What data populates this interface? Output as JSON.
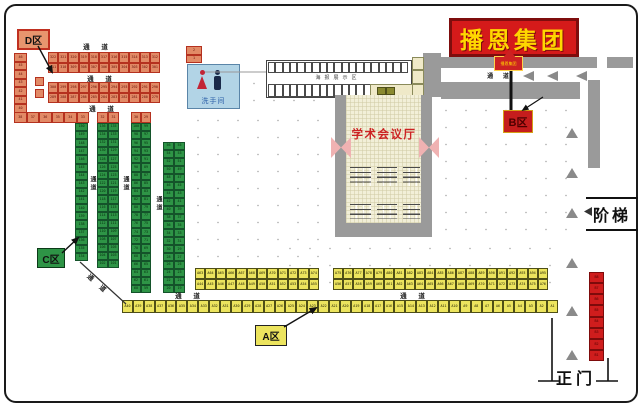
{
  "sign": {
    "text": "播恩集团"
  },
  "zones": {
    "d": "D区",
    "c": "C区",
    "a": "A区",
    "b": "B区"
  },
  "labels": {
    "aisle": "通 道",
    "aisle_v": "通道",
    "restroom": "洗手间",
    "hall": "学术会议厅",
    "stairs": "阶梯",
    "gate": "正门",
    "display_area": "海报展示区",
    "wall_booth": "播恩集团"
  },
  "colors": {
    "sign_bg": "#d51a1a",
    "sign_text": "#ffd700",
    "sign_border": "#7e0d0d",
    "seat_red": "#e28a66",
    "seat_red_border": "#b5311f",
    "seat_green": "#2e9446",
    "seat_green_border": "#14532a",
    "seat_yellow": "#ece45e",
    "seat_yellow_border": "#4f4f17",
    "seat_deepred": "#cf1d1d",
    "wall_gray": "#9a9a9a",
    "door_pink": "#f0b2b2",
    "hall_floor": "#f2efd8",
    "hall_text": "#cc2222",
    "restroom_bg": "#b2d4e6",
    "restroom_text": "#2b5fa8",
    "arrow_gray": "#8a8a8a"
  },
  "seat_blocks": {
    "d_col_left": {
      "cols": 1,
      "rows": 8,
      "cls": "s-red",
      "start": 46,
      "step": -1
    },
    "d_single_1": {
      "cols": 1,
      "rows": 1,
      "cls": "s-red"
    },
    "d_single_2": {
      "cols": 1,
      "rows": 1,
      "cls": "s-red"
    },
    "d_row_1": {
      "cols": 11,
      "rows": 2,
      "cls": "s-red",
      "start": 322,
      "step": -1
    },
    "d_row_2": {
      "cols": 11,
      "rows": 2,
      "cls": "s-red",
      "start": 300,
      "step": -1
    },
    "d_row_bottom": {
      "cols": 6,
      "rows": 1,
      "cls": "s-red",
      "start": 38,
      "step": -1
    },
    "d_top_c2": {
      "cols": 2,
      "rows": 1,
      "cls": "s-red",
      "start": 32,
      "step": -1
    },
    "d_top_c3": {
      "cols": 2,
      "rows": 1,
      "cls": "s-red",
      "start": 30,
      "step": -1
    },
    "c_col_1": {
      "cols": 1,
      "rows": 17,
      "cls": "s-green",
      "start": 150,
      "step": -1
    },
    "c_col_2": {
      "cols": 2,
      "rows": 18,
      "cls": "s-green",
      "start": 136,
      "step": -1
    },
    "c_col_3": {
      "cols": 2,
      "rows": 21,
      "cls": "s-green",
      "start": 100,
      "step": -1
    },
    "c_col_4": {
      "cols": 2,
      "rows": 19,
      "cls": "s-green",
      "start": 56,
      "step": -1
    },
    "a_top_1a": {
      "cols": 12,
      "rows": 1,
      "cls": "s-yellow",
      "prefix": "A",
      "start": 63,
      "step": 1
    },
    "a_top_1b": {
      "cols": 12,
      "rows": 1,
      "cls": "s-yellow",
      "prefix": "A",
      "start": 44,
      "step": 1
    },
    "a_top_2a": {
      "cols": 21,
      "rows": 1,
      "cls": "s-yellow",
      "prefix": "A",
      "start": 75,
      "step": 1
    },
    "a_top_2b": {
      "cols": 21,
      "rows": 1,
      "cls": "s-yellow",
      "prefix": "A",
      "start": 56,
      "step": 1
    },
    "a_row_bottom": {
      "cols": 40,
      "rows": 1,
      "cls": "s-yellow",
      "prefix": "A",
      "start": 40,
      "step": -1
    },
    "b_col_right": {
      "cols": 1,
      "rows": 8,
      "cls": "s-deepred",
      "prefix": "B",
      "start": 8,
      "step": -1
    },
    "wc_top": {
      "cols": 1,
      "rows": 2,
      "cls": "s-red",
      "start": 2,
      "step": -1
    },
    "booth_row_top": {
      "cols": 19,
      "rows": 1,
      "cls": "s-booth"
    },
    "booth_row_bottom": {
      "cols": 14,
      "rows": 1,
      "cls": "s-booth"
    },
    "booth_strip_right": {
      "cols": 1,
      "rows": 3,
      "cls": "s-boothy"
    },
    "booth_dark_pair": {
      "cols": 2,
      "rows": 1,
      "cls": "s-dark"
    }
  }
}
